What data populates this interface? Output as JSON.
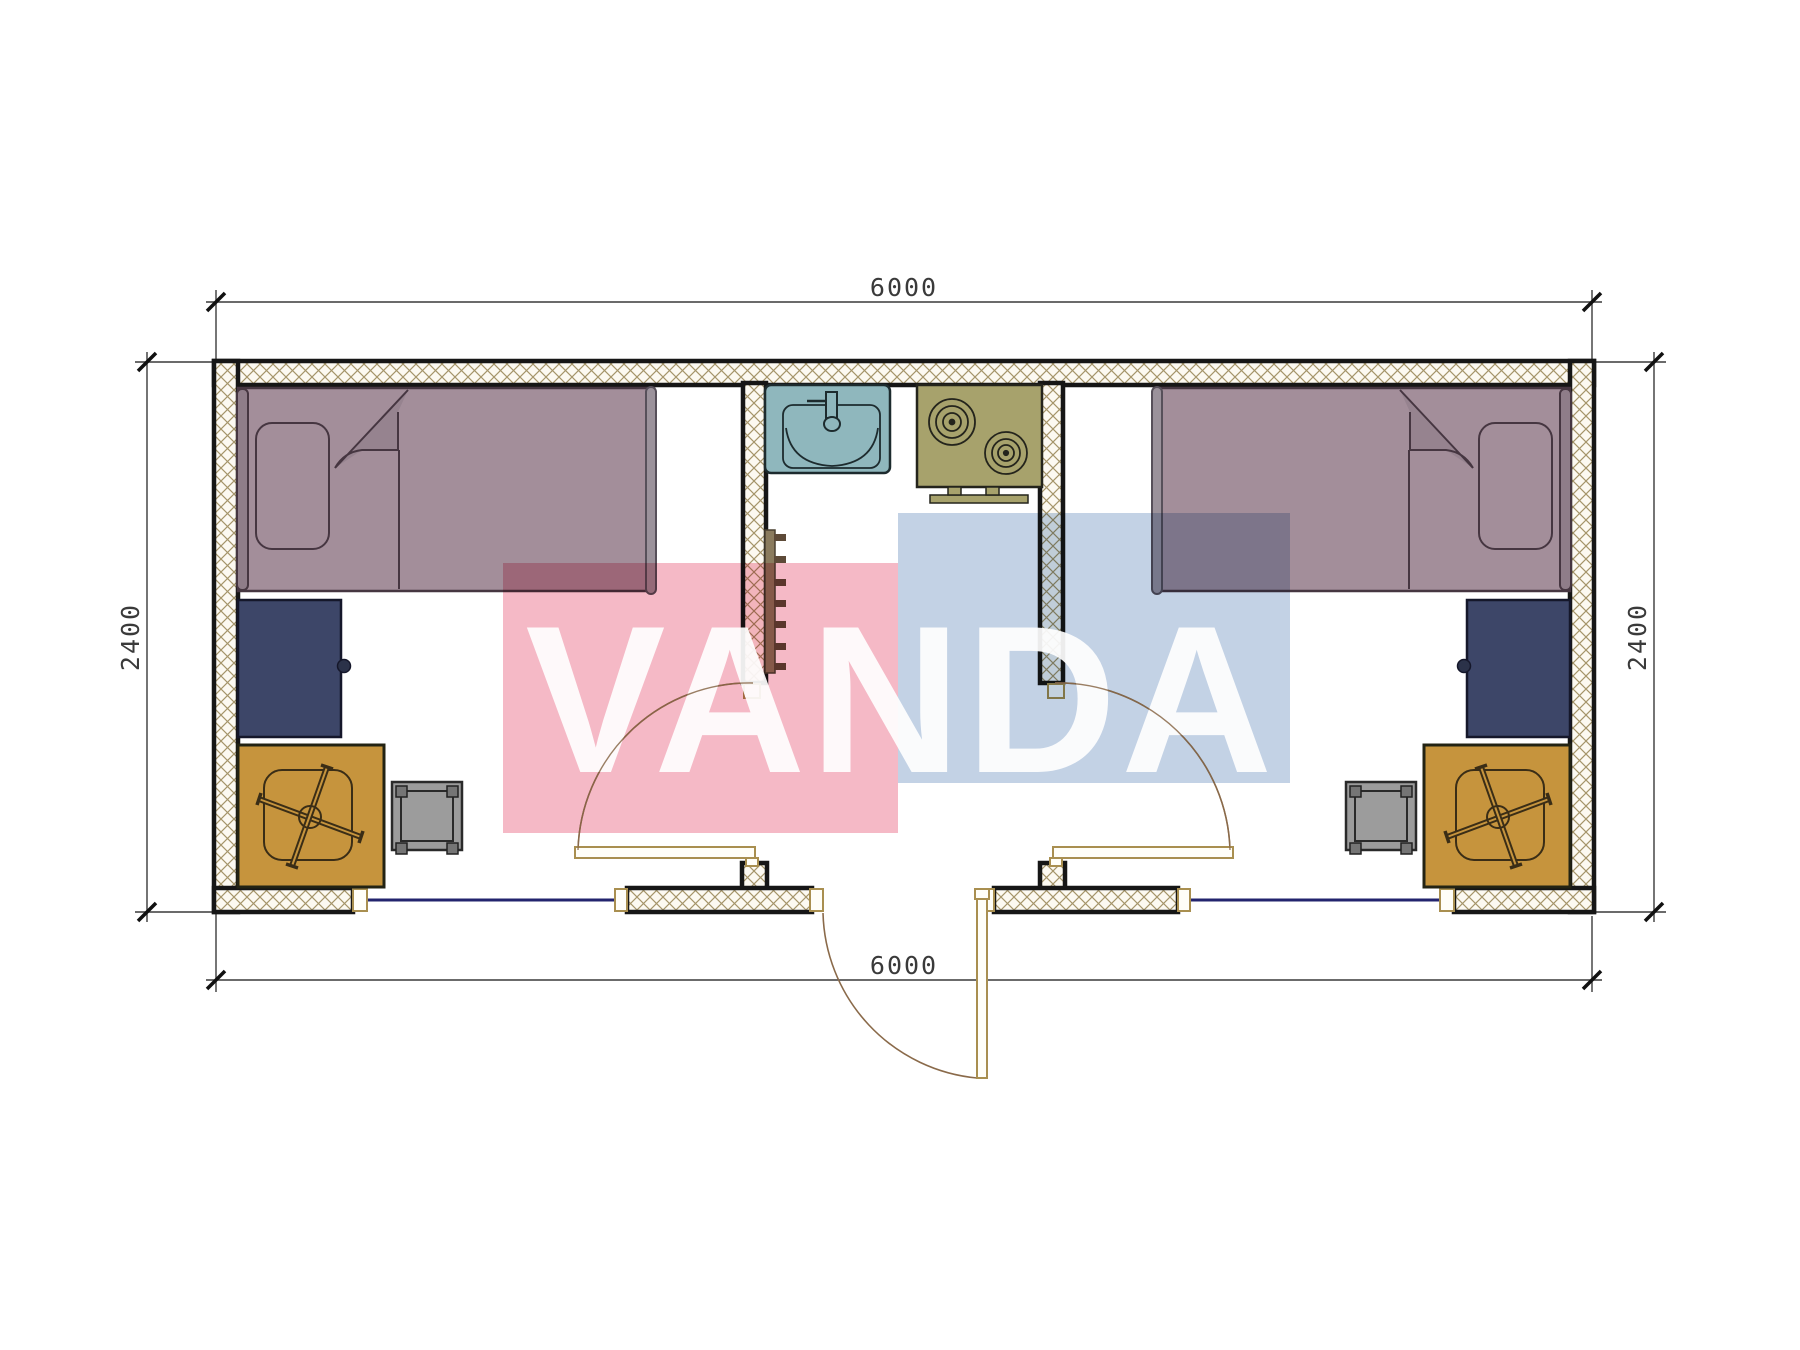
{
  "drawing": {
    "type": "floor-plan",
    "watermark": {
      "text": "VANDA"
    },
    "dimensions": {
      "top": "6000",
      "bottom": "6000",
      "left": "2400",
      "right": "2400"
    }
  },
  "colors": {
    "background": "#ffffff",
    "wall_line": "#161616",
    "hatch_line": "#a5956a",
    "hatch_bg": "#fcf9f1",
    "bed": "#a38e9a",
    "bed_outline": "#463641",
    "headboard": "#8f7d89",
    "footboard": "#9b929b",
    "desk": "#3d4668",
    "desk_outline": "#15172a",
    "chair_desk": "#c6943d",
    "chair_line": "#3a2d16",
    "stool": "#9c9c9c",
    "stool_post": "#757575",
    "sink": "#8fb7bd",
    "sink_line": "#1d2b2e",
    "stove": "#a7a26c",
    "stove_line": "#24241c",
    "ladder": "#8a7b5e",
    "ladder_rung": "#5d4a38",
    "door_frame": "#a98f50",
    "door_arc": "#8a6a4a",
    "window_glass": "#23246e",
    "dimension": "#3a3a3a",
    "watermark_pink": "#f5b9c6",
    "watermark_blue": "#c3d2e5",
    "watermark_text": "#ffffff"
  }
}
